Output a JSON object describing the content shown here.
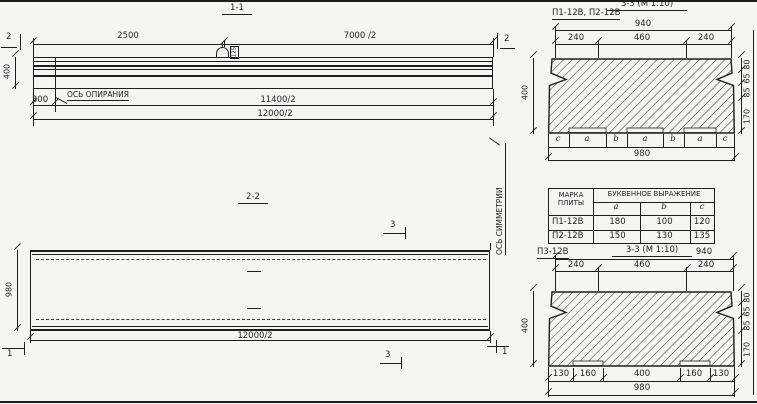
{
  "section_1_1": {
    "title": "1-1",
    "dim_top_left": "2500",
    "dim_top_right": "7000 /2",
    "marker_left": "2",
    "marker_right": "2",
    "height": "400",
    "dim_support": "300",
    "support_axis_label": "ОСЬ ОПИРАНИЯ",
    "loop_label": "125",
    "dim_half_inner": "11400/2",
    "dim_half_outer": "12000/2"
  },
  "section_2_2": {
    "title": "2-2",
    "width": "980",
    "dim_half": "12000/2",
    "marker_top": "3",
    "marker_bottom": "3",
    "marker_left": "1",
    "marker_right": "1",
    "symmetry_axis_label": "ОСЬ СИММЕТРИИ"
  },
  "section_3_3_top": {
    "label": "П1-12В, П2-12В",
    "title": "3-3 (М 1:10)",
    "dim_total_top": "940",
    "dim_seg_left": "240",
    "dim_seg_mid": "460",
    "dim_seg_right": "240",
    "height": "400",
    "right_dims": [
      "80",
      "65",
      "85",
      "170"
    ],
    "bottom_letters": [
      "с",
      "а",
      "b",
      "а",
      "b",
      "а",
      "с"
    ],
    "dim_total_bottom": "980"
  },
  "plate_table": {
    "header_mark": "МАРКА ПЛИТЫ",
    "header_expr": "БУКВЕННОЕ ВЫРАЖЕНИЕ",
    "subheaders": [
      "а",
      "b",
      "с"
    ],
    "rows": [
      {
        "mark": "П1-12В",
        "a": "180",
        "b": "100",
        "c": "120"
      },
      {
        "mark": "П2-12В",
        "a": "150",
        "b": "130",
        "c": "135"
      }
    ]
  },
  "section_3_3_bottom": {
    "label": "П3-12В",
    "title": "3-3 (М 1:10)",
    "dim_total_top": "940",
    "dim_seg_left": "240",
    "dim_seg_mid": "460",
    "dim_seg_right": "240",
    "height": "400",
    "right_dims": [
      "80",
      "65",
      "85",
      "170"
    ],
    "bottom_segments": [
      "130",
      "160",
      "400",
      "160",
      "130"
    ],
    "dim_total_bottom": "980"
  }
}
